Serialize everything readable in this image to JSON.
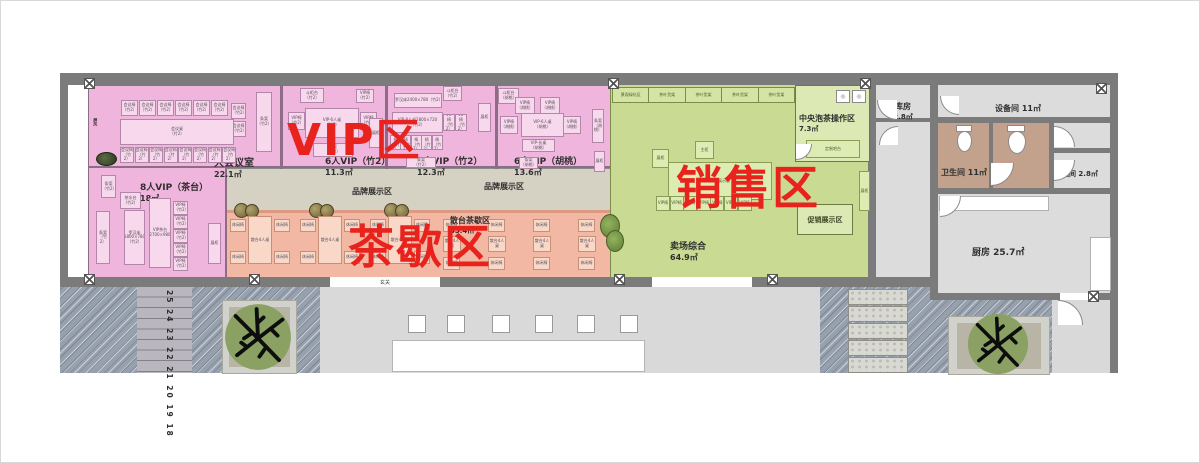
{
  "zone_titles": {
    "vip": "VIP区",
    "tea": "茶歇区",
    "sales": "销售区"
  },
  "rooms": {
    "meeting": {
      "name": "大会议室",
      "area": "22.1㎡"
    },
    "vip6_zhu": {
      "name": "6人VIP（竹2）",
      "area": "11.3㎡"
    },
    "vip8_zhu": {
      "name": "8人VIP（竹2）",
      "area": "12.3㎡"
    },
    "vip6_hutao": {
      "name": "6人VIP（胡桃）",
      "area": "13.6㎡"
    },
    "vip8_chatai": {
      "name": "8人VIP（茶台）",
      "area": "18㎡"
    },
    "brand1": {
      "name": "品牌展示区"
    },
    "brand2": {
      "name": "品牌展示区"
    },
    "scatter_tea": {
      "name": "散台茶歇区",
      "area": "35.4㎡"
    },
    "central_tea": {
      "name": "中央泡茶操作区",
      "area": "7.3㎡"
    },
    "promo": {
      "name": "促销展示区"
    },
    "sales_floor": {
      "name": "卖场综合",
      "area": "64.9㎡"
    },
    "storeroom": {
      "name": "库房",
      "area": "2.8㎡"
    },
    "equipment": {
      "name": "设备间 11㎡"
    },
    "restroom": {
      "name": "卫生间 11㎡"
    },
    "storage2": {
      "name": "储藏间 2.8㎡"
    },
    "kitchen": {
      "name": "厨房  25.7㎡"
    },
    "entrance": {
      "name": "玄关"
    }
  },
  "furniture": {
    "meeting_chair": "会议椅\n（竹2）",
    "meeting_table": "会议桌\n（竹2）",
    "vip_chair_z": "VIP椅\n（竹2）",
    "vip_chair_h": "VIP椅\n（胡桃）",
    "vip_chair": "VIP椅",
    "vip6_table_z": "VIP-6人桌\n（竹2）",
    "vip8_table_z": "VIP-8人桌2800×720\n（竹2）",
    "vip6_table_h": "VIP-6人桌\n（胡桃）",
    "vip_long_h": "VIP-长桌\n（胡桃）",
    "luohan24": "罗汉床2400×780（竹2）",
    "luohan18": "罗汉床\n1800×780\n（竹2）",
    "tea_table": "VIP茶台\n2700×980",
    "tiaoan_z": "条案\n（竹2）",
    "tiaoan_h": "条案\n（胡桃）",
    "dougui_z": "斗柜台\n（竹2）",
    "dougui_h": "斗柜台\n（胡桃）",
    "screen": "屏风",
    "water_station": "茶水台\n（竹2）",
    "scatter_table": "散台4人桌",
    "leisure_chair": "休闲椅",
    "custom_bar": "定制吧台",
    "main_cab": "主柜",
    "product_table": "产品展示台",
    "display_cab": "展柜"
  },
  "shelf_labels": [
    "景观绿化区",
    "茶叶货架",
    "茶叶货架",
    "茶叶货架",
    "茶叶货架",
    "茶叶货架",
    "景观绿化区"
  ],
  "stair_numbers": "25 24 23 22 21 20 19 18",
  "colors": {
    "zone_vip": "#f0b5dc",
    "zone_tea": "#f2b8a3",
    "zone_sales": "#c9da92",
    "brand_strip": "#d6d2c3",
    "wall": "#7b7b7b",
    "title_red": "#e8231d"
  }
}
